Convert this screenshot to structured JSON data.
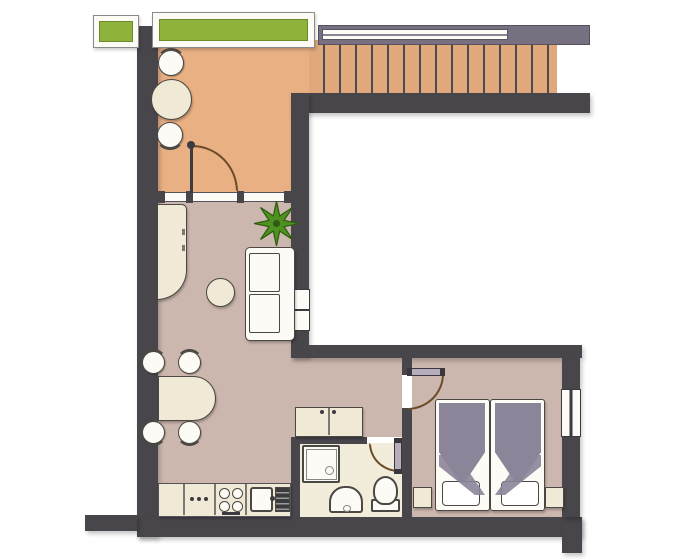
{
  "title": "Apartment floor plan (top view)",
  "canvas": {
    "width": 700,
    "height": 560
  },
  "colors": {
    "wall": "#48464b",
    "hallFloor": "#e8b083",
    "livingFloor": "#ccb7ae",
    "bathFloor": "#f2edda",
    "stairTread": "#e1a87c",
    "stairLine": "#4d4a4e",
    "grayBand": "#777080",
    "planterGreen": "#8eb23b",
    "cream": "#efe9d5",
    "outline": "#4b4742",
    "blanket": "#8c8499",
    "paper": "#fcfbf6",
    "doorArc": "#6b4b26",
    "doorLeaf": "#b6aebd",
    "plantGreen": "#4f9120",
    "drainboard": "#3b3b3d"
  },
  "rooms": [
    {
      "id": "hall",
      "label": "entrance hall / winter garden",
      "floor_color": "hallFloor",
      "furniture": [
        "round bistro table",
        "chair (north)",
        "chair (south)"
      ]
    },
    {
      "id": "staircase",
      "label": "staircase",
      "treads": 15,
      "handrail": true,
      "direction": "horizontal"
    },
    {
      "id": "living-room",
      "label": "living room",
      "floor_color": "livingFloor",
      "furniture": [
        "corner counter/desk",
        "two-seat sofa",
        "round coffee table",
        "potted plant",
        "dining table",
        "4 dining chairs",
        "sideboard cabinet"
      ]
    },
    {
      "id": "kitchen-zone",
      "label": "kitchen zone",
      "floor_color": "livingFloor",
      "furniture": [
        "base cabinet",
        "appliance with 3 knobs",
        "cooktop with 4 burners",
        "sink with drainboard"
      ]
    },
    {
      "id": "bathroom",
      "label": "bathroom",
      "floor_color": "bathFloor",
      "furniture": [
        "shower tray with drain",
        "pedestal washbasin",
        "toilet with cistern"
      ]
    },
    {
      "id": "bedroom",
      "label": "bedroom",
      "floor_color": "livingFloor",
      "furniture": [
        "single bed 1",
        "single bed 2",
        "nightstand left",
        "nightstand right"
      ],
      "beds": 2,
      "nightstands": 2
    },
    {
      "id": "void",
      "label": "open void / lightwell",
      "floor_color": "paper"
    }
  ],
  "openings": {
    "doors": [
      {
        "id": "hall-door",
        "room": "hall",
        "swing": "north-east quarter arc"
      },
      {
        "id": "bedroom-door",
        "room": "bedroom",
        "swing": "south-east quarter arc"
      },
      {
        "id": "bathroom-door",
        "room": "bathroom",
        "swing": "south-west quarter arc"
      }
    ],
    "windows": [
      {
        "id": "planter-box-left",
        "type": "green planter box"
      },
      {
        "id": "planter-box-top",
        "type": "green planter box"
      },
      {
        "id": "glazed-partition",
        "type": "glass partition hall/living",
        "posts": 4
      },
      {
        "id": "pass-through-window",
        "type": "window in void wall",
        "panes": 2
      },
      {
        "id": "bedroom-window",
        "type": "window in east wall",
        "panes": 2
      }
    ]
  },
  "kitchen_details": {
    "burners": 4,
    "knob_dots": 3,
    "drainboard_slats": 4
  }
}
